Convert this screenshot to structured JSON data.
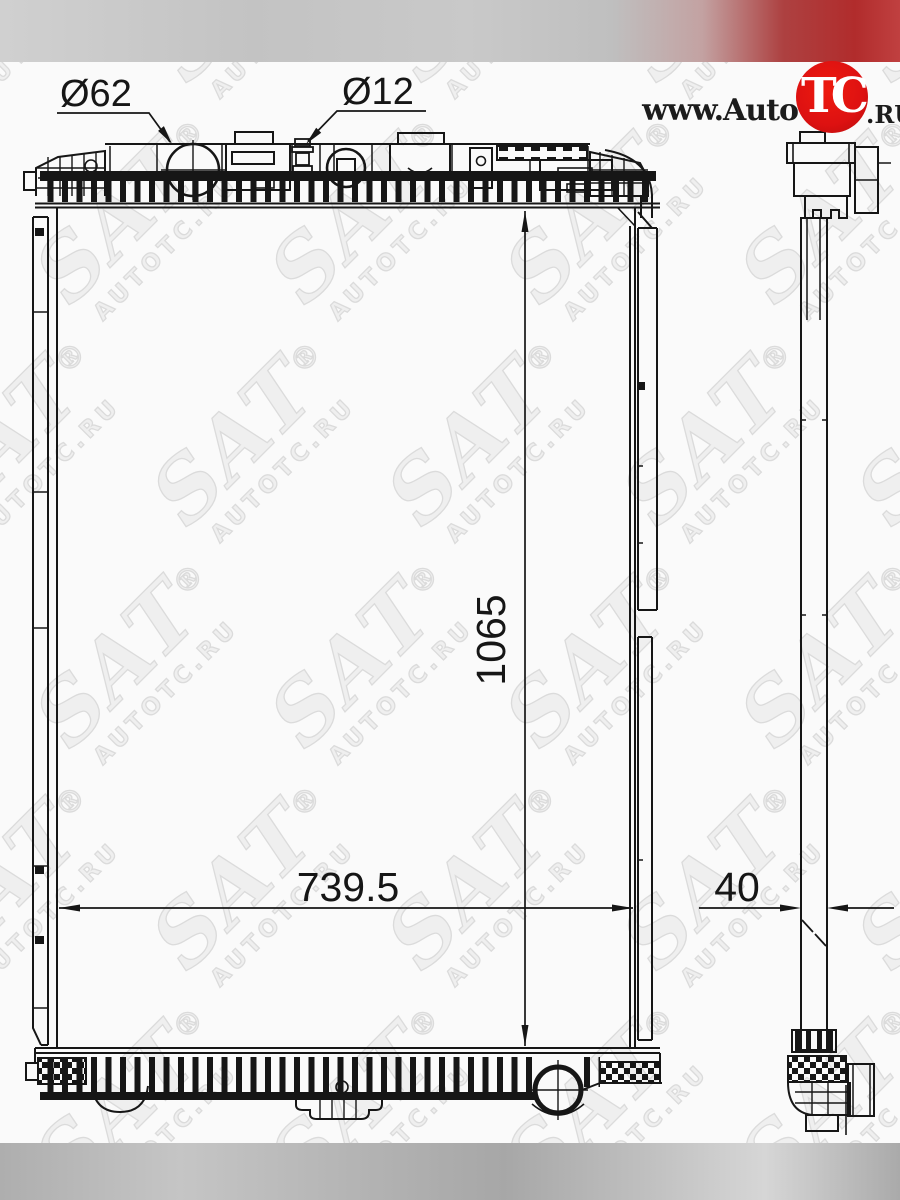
{
  "branding": {
    "logo_prefix": "www.Auto",
    "logo_circle": "TC",
    "logo_suffix": ".RU",
    "logo_circle_color": "#dd1111",
    "logo_text_color": "#1c1c1c"
  },
  "watermark": {
    "brand": "SAT",
    "registered": "®",
    "site": "AUTOTC.RU",
    "color": "#dbdbdb"
  },
  "drawing": {
    "dim_filler_neck": "Ø62",
    "dim_inlet": "Ø12",
    "dim_height": "1065",
    "dim_width": "739.5",
    "dim_depth": "40",
    "line_color": "#161616"
  }
}
